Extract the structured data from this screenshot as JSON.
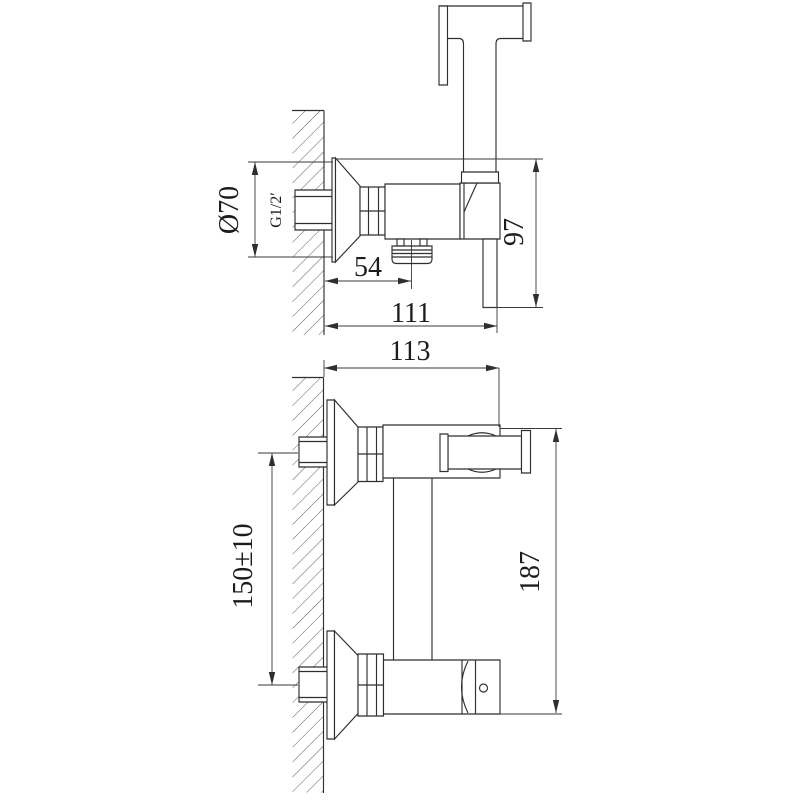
{
  "figure": {
    "type": "technical-drawing",
    "subject": "Wall-mounted hygienic shower bidet mixer — dimensional drawing with side view (top) and front view (bottom)"
  },
  "colors": {
    "background": "#ffffff",
    "line": "#2f2f2f",
    "hatch": "#4a4a4a",
    "text": "#1c1c1c"
  },
  "dims": {
    "dia70": "Ø70",
    "g12": "G1/2′",
    "d54": "54",
    "d111": "111",
    "d97": "97",
    "d113": "113",
    "d150": "150±10",
    "d187": "187"
  }
}
